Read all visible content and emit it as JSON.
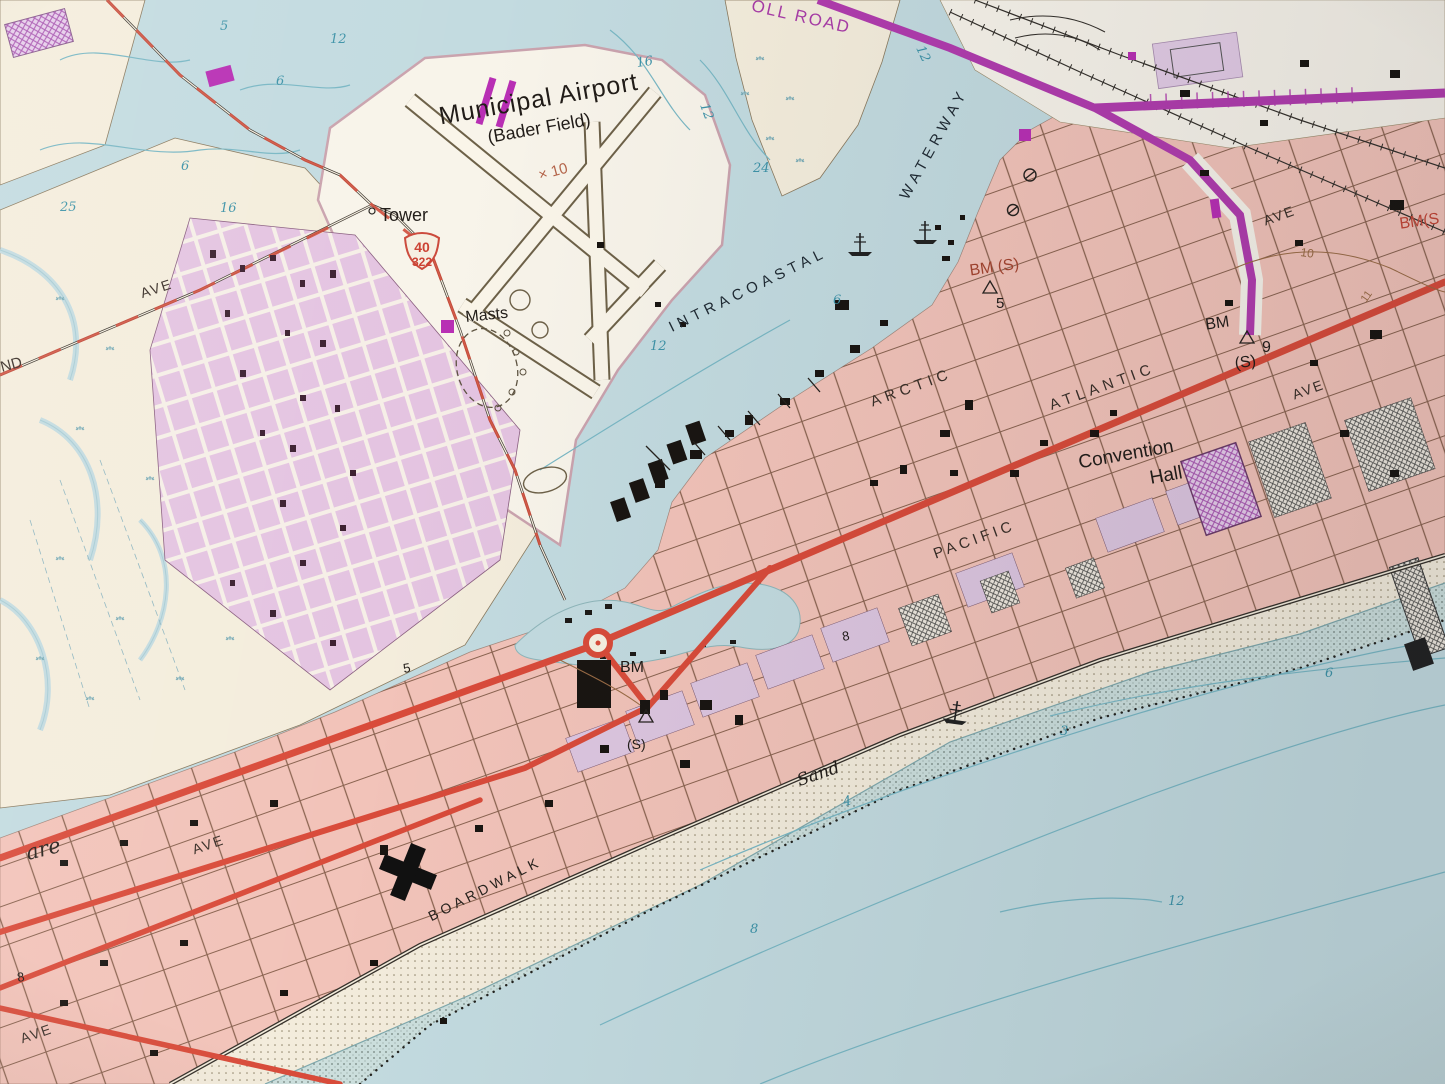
{
  "colors": {
    "water": "#c3dbe0",
    "land": "#f4eddc",
    "airport_land": "#f8f4ea",
    "urban_pink": "#f2c3b9",
    "urban_lavender": "#e4c4e1",
    "road_red": "#d94b3a",
    "toll_purple": "#b13cae",
    "contour_blue": "#79b7c4",
    "depth_text": "#3e93a8",
    "foreshore": "#ccdfdd"
  },
  "airport": {
    "name": "Municipal Airport",
    "field": "(Bader Field)",
    "tower": "Tower",
    "masts": "Masts",
    "spot_elev": "× 10"
  },
  "routes": {
    "us_shield_top": "40",
    "us_shield_bottom": "322",
    "toll_road": "OLL ROAD"
  },
  "water_features": {
    "intracoastal": "INTRACOASTAL",
    "waterway": "WATERWAY",
    "sand": "Sand"
  },
  "streets": {
    "arctic": "ARCTIC",
    "atlantic": "ATLANTIC",
    "pacific": "PACIFIC",
    "boardwalk": "BOARDWALK",
    "ave_ne": "AVE",
    "ave_e": "AVE",
    "ave_w": "AVE",
    "ave_sw1": "AVE",
    "ave_sw2": "AVE",
    "are": "are",
    "nd": "ND"
  },
  "places": {
    "convention_line1": "Convention",
    "convention_line2": "Hall"
  },
  "benchmarks": {
    "bm_atlantic": "BM",
    "bm_atlantic_s": "(S)",
    "bm_atlantic_val": "9",
    "bm_marina": "BM (S)",
    "bm_marina_val": "5",
    "bm_circle": "BM",
    "bm_circle_s": "(S)",
    "bm_edge": "BM(S"
  },
  "spot_elevations": {
    "left_8": "8",
    "center_5": "5",
    "mid_8": "8"
  },
  "contour_labels": {
    "c10": "10",
    "c11": "11"
  },
  "depths": {
    "tl_5": "5",
    "tl_12": "12",
    "tl_6a": "6",
    "tl_6b": "6",
    "tl_25": "25",
    "tl_16": "16",
    "bay_16": "16",
    "bay_12": "12",
    "bay_24": "24",
    "bay_12b": "12",
    "chan_6": "6",
    "chan_12": "12",
    "oc_4": "4",
    "oc_8": "8",
    "oc_12": "12",
    "oc_6": "6",
    "oc_3": "3"
  }
}
